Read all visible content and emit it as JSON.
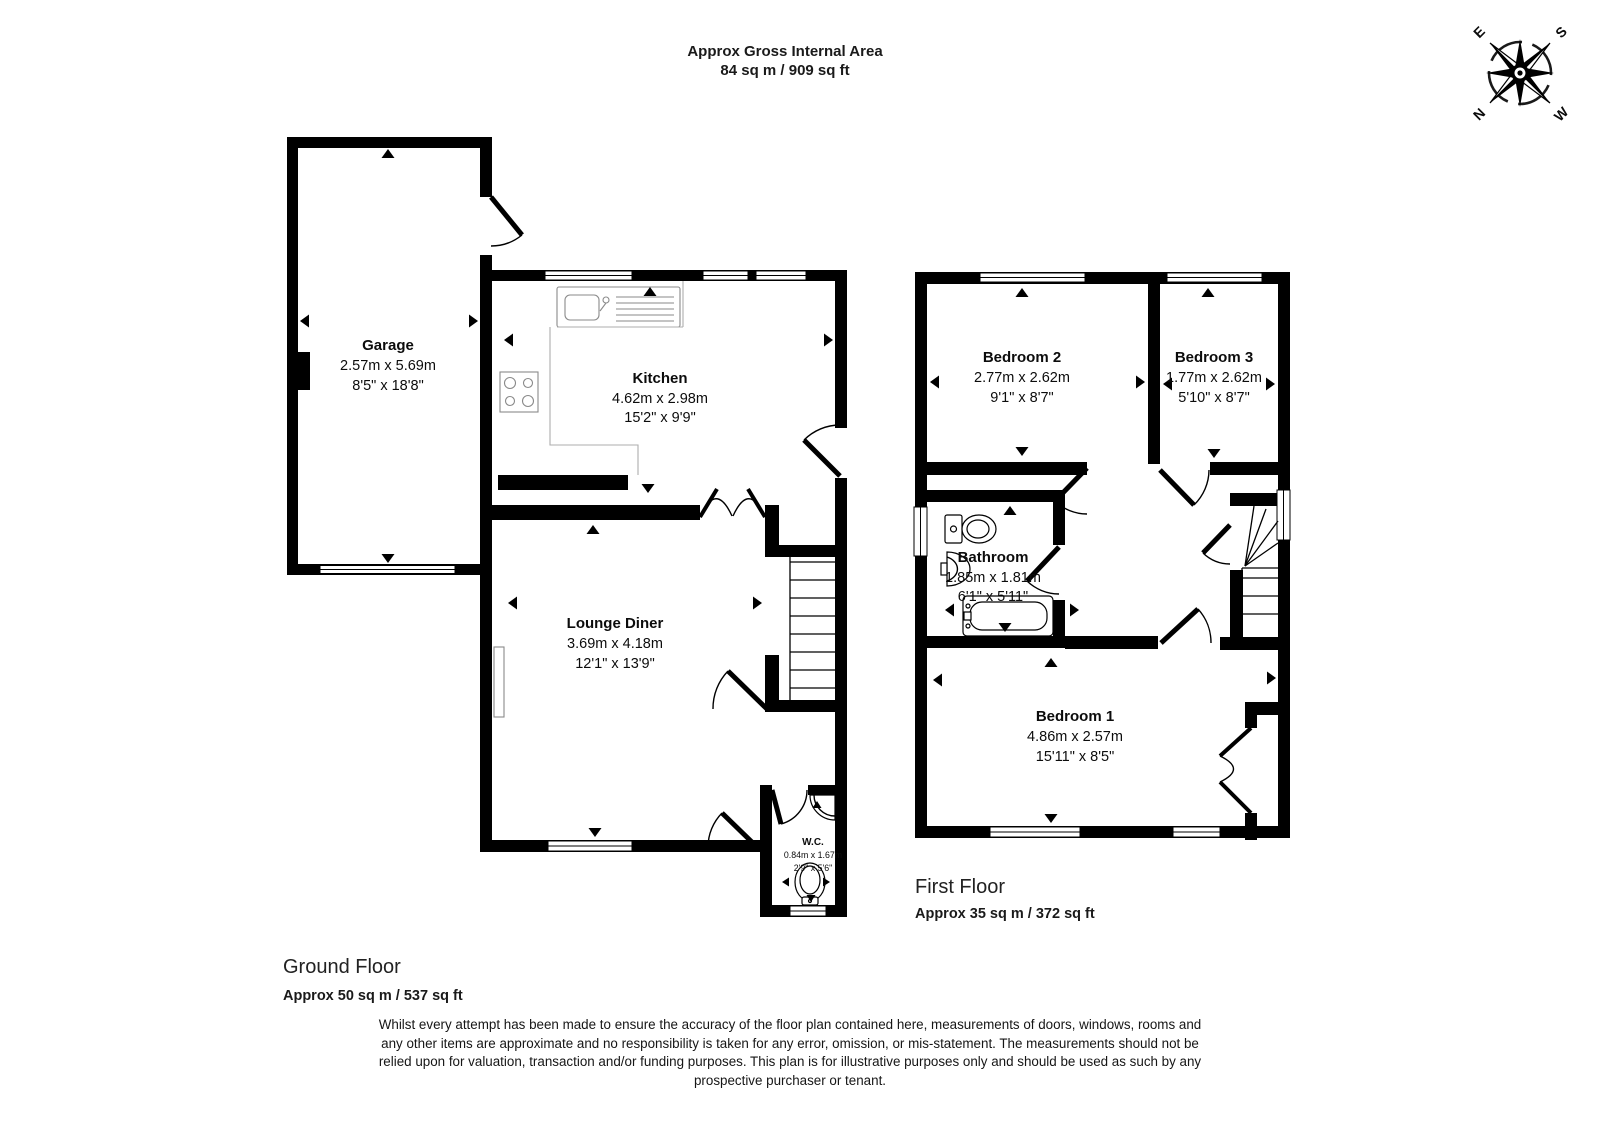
{
  "header": {
    "title": "Approx Gross Internal Area",
    "subtitle": "84 sq m / 909 sq ft"
  },
  "compass": {
    "north": "N",
    "east": "E",
    "south": "S",
    "west": "W"
  },
  "ground": {
    "label": "Ground Floor",
    "area": "Approx 50 sq m / 537 sq ft",
    "rooms": {
      "garage": {
        "name": "Garage",
        "metric": "2.57m x 5.69m",
        "imperial": "8'5\" x 18'8\""
      },
      "kitchen": {
        "name": "Kitchen",
        "metric": "4.62m x 2.98m",
        "imperial": "15'2\" x 9'9\""
      },
      "lounge": {
        "name": "Lounge Diner",
        "metric": "3.69m x 4.18m",
        "imperial": "12'1\" x 13'9\""
      },
      "wc": {
        "name": "W.C.",
        "metric": "0.84m x 1.67m",
        "imperial": "2'9\" x 5'6\""
      }
    }
  },
  "first": {
    "label": "First Floor",
    "area": "Approx 35 sq m / 372 sq ft",
    "rooms": {
      "bedroom2": {
        "name": "Bedroom 2",
        "metric": "2.77m x 2.62m",
        "imperial": "9'1\" x 8'7\""
      },
      "bedroom3": {
        "name": "Bedroom 3",
        "metric": "1.77m x 2.62m",
        "imperial": "5'10\" x 8'7\""
      },
      "bathroom": {
        "name": "Bathroom",
        "metric": "1.85m x 1.81m",
        "imperial": "6'1\" x 5'11\""
      },
      "bedroom1": {
        "name": "Bedroom 1",
        "metric": "4.86m x 2.57m",
        "imperial": "15'11\" x 8'5\""
      }
    }
  },
  "disclaimer": {
    "line1": "Whilst every attempt has been made to ensure the accuracy of the floor plan contained here, measurements of doors, windows, rooms and",
    "line2": "any other items are approximate and no responsibility is taken for any error, omission, or mis-statement. The measurements should not be",
    "line3": "relied upon for valuation, transaction and/or funding purposes. This plan is for illustrative purposes only and should be used as such by any",
    "line4": "prospective purchaser or tenant."
  }
}
